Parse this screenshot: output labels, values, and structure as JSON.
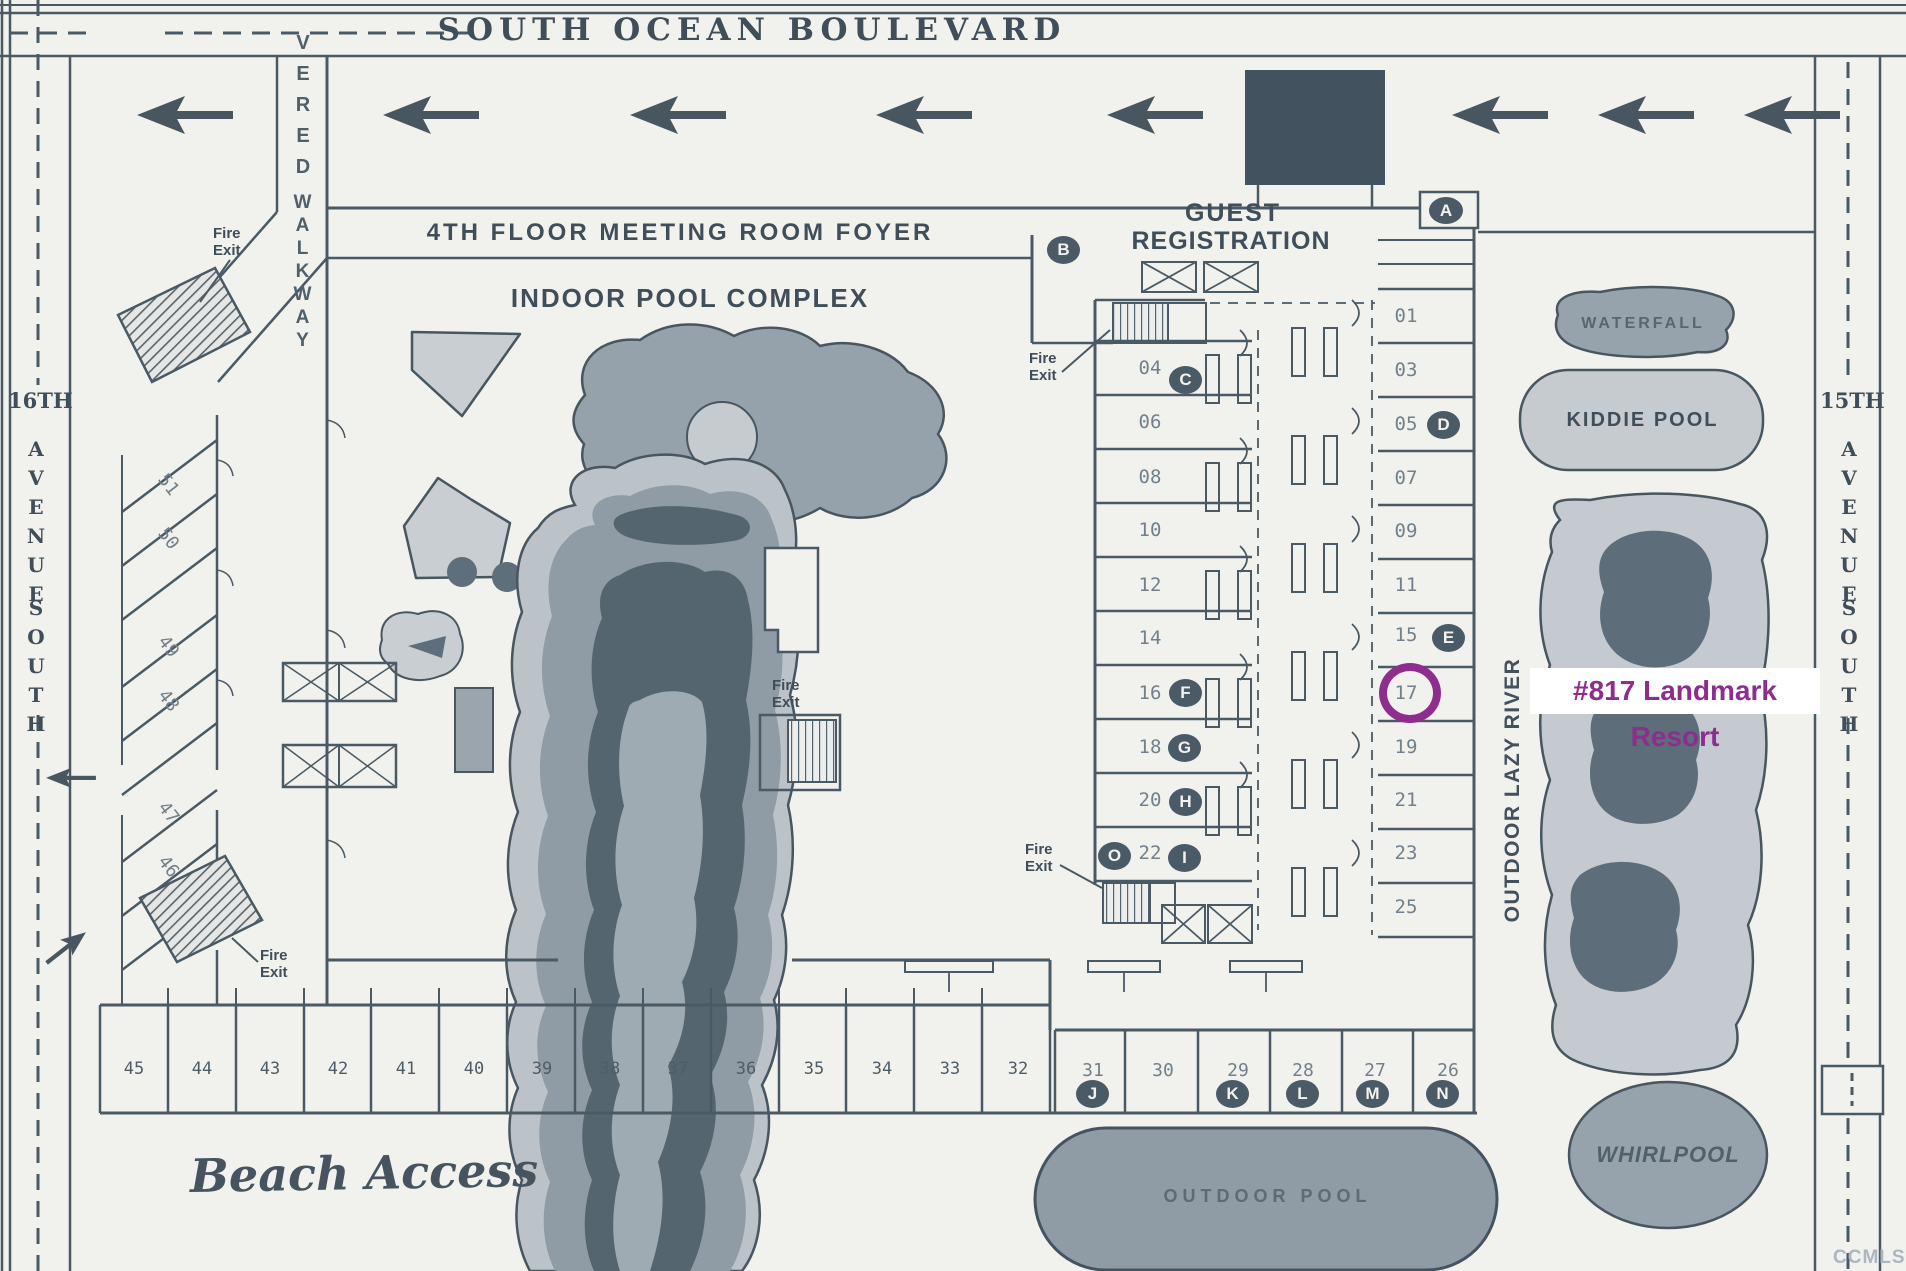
{
  "title": "Landmark Resort site map",
  "colors": {
    "paper": "#f1f1ee",
    "ink": "#47565f",
    "pool_light": "#c6cbd0",
    "pool_mid": "#96a2ab",
    "pool_dark": "#5d6d79",
    "badge": "#4a5a66",
    "canopy": "#42525e",
    "annotation_purple": "#8e2d8e"
  },
  "streets": {
    "top": {
      "name": "SOUTH OCEAN BOULEVARD"
    },
    "left": {
      "prefix": "16TH",
      "word1": "AVENUE",
      "word2": "SOUTH"
    },
    "right": {
      "prefix": "15TH",
      "word1": "AVENUE",
      "word2": "SOUTH"
    }
  },
  "walkway": {
    "word1": "VERED",
    "word2": "WALKWAY"
  },
  "labels": {
    "foyer": "4TH FLOOR MEETING ROOM FOYER",
    "indoor_pool": "INDOOR POOL COMPLEX",
    "guest_registration_line1": "GUEST",
    "guest_registration_line2": "REGISTRATION",
    "waterfall": "WATERFALL",
    "kiddie_pool": "KIDDIE POOL",
    "lazy_river": "OUTDOOR LAZY RIVER",
    "whirlpool": "WHIRLPOOL",
    "outdoor_pool": "OUTDOOR POOL",
    "beach_access": "Beach Access",
    "watermark": "CCMLS"
  },
  "fire_exit": {
    "line1": "Fire",
    "line2": "Exit"
  },
  "badges": {
    "entrance": "A",
    "registration": "B"
  },
  "rooms": {
    "left": [
      {
        "num": "04",
        "badge": "C"
      },
      {
        "num": "06"
      },
      {
        "num": "08"
      },
      {
        "num": "10"
      },
      {
        "num": "12"
      },
      {
        "num": "14"
      },
      {
        "num": "16",
        "badge": "F"
      },
      {
        "num": "18",
        "badge": "G"
      },
      {
        "num": "20",
        "badge": "H"
      },
      {
        "num": "22",
        "badge": "I",
        "badge_left": "O"
      }
    ],
    "right": [
      {
        "num": "01"
      },
      {
        "num": "03"
      },
      {
        "num": "05",
        "badge": "D"
      },
      {
        "num": "07"
      },
      {
        "num": "09"
      },
      {
        "num": "11"
      },
      {
        "num": "15",
        "badge": "E"
      },
      {
        "num": "17",
        "highlighted": true
      },
      {
        "num": "19"
      },
      {
        "num": "21"
      },
      {
        "num": "23"
      },
      {
        "num": "25"
      }
    ],
    "bottom": [
      {
        "num": "31",
        "badge": "J"
      },
      {
        "num": "30"
      },
      {
        "num": "29",
        "badge": "K"
      },
      {
        "num": "28",
        "badge": "L"
      },
      {
        "num": "27",
        "badge": "M"
      },
      {
        "num": "26",
        "badge": "N"
      }
    ]
  },
  "parking": {
    "beach_stalls": [
      "45",
      "44",
      "43",
      "42",
      "41",
      "40",
      "39",
      "38",
      "37",
      "36",
      "35",
      "34",
      "33",
      "32"
    ],
    "diagonal_stalls": [
      "51",
      "50",
      "49",
      "48",
      "47",
      "46"
    ]
  },
  "annotation": {
    "text": "#817 Landmark Resort",
    "circled_room": "17"
  }
}
